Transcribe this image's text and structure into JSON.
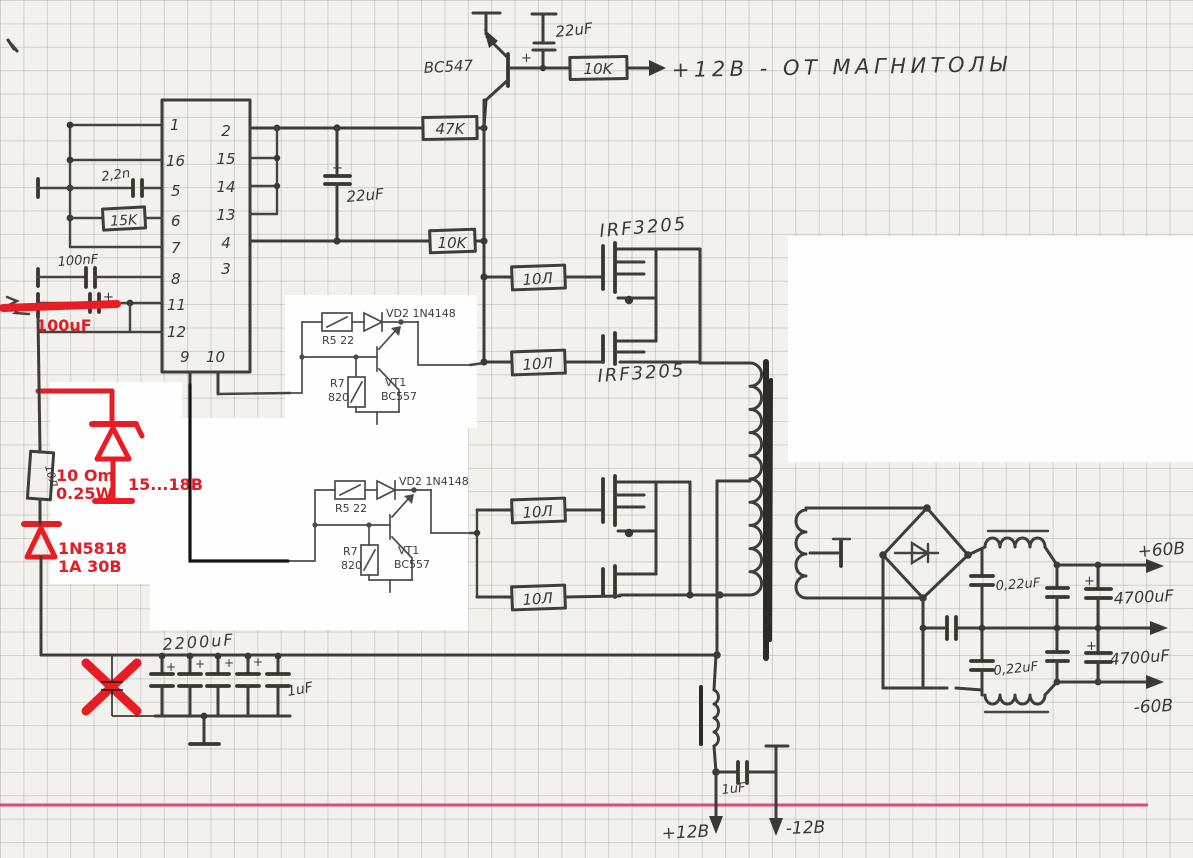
{
  "top": {
    "transistor": "BC547",
    "cap": "22uF",
    "resistor": "10K",
    "output_label": "+12В - ОТ МАГНИТОЛЫ"
  },
  "feedback": {
    "res_top": "47K",
    "cap": "22uF",
    "res_bottom": "10K"
  },
  "ic": {
    "left_pins": [
      "1",
      "16",
      "5",
      "6",
      "7",
      "8",
      "11",
      "12"
    ],
    "right_pins": [
      "2",
      "15",
      "14",
      "13",
      "4",
      "3"
    ],
    "bottom_pins": [
      "9",
      "10"
    ]
  },
  "left_inputs": {
    "timing_cap": "2,2n",
    "timing_res": "15K",
    "cap_100n": "100nF",
    "red_cap_note": "100uF"
  },
  "series": {
    "hand_res": "10Л"
  },
  "red_notes": {
    "series_res": "10 Om",
    "series_res_power": "0.25W",
    "zener": "15...18В",
    "schottky": "1N5818",
    "schottky_rating": "1A 30В"
  },
  "gate_resistors": [
    "10Л",
    "10Л",
    "10Л",
    "10Л"
  ],
  "mosfets": {
    "label_top": "IRF3205",
    "label_bottom": "IRF3205"
  },
  "drivers": [
    {
      "r5": "R5 22",
      "vd2": "VD2 1N4148",
      "r7": "R7",
      "r7_val": "820",
      "vt1": "VT1",
      "vt1_type": "BC557"
    },
    {
      "r5": "R5 22",
      "vd2": "VD2 1N4148",
      "r7": "R7",
      "r7_val": "820",
      "vt1": "VT1",
      "vt1_type": "BC557"
    }
  ],
  "bulk": {
    "bank_label": "2200uF",
    "small_cap": "1uF"
  },
  "output": {
    "film_cap_top": "0,22uF",
    "film_cap_bottom": "0,22uF",
    "elec_top": "4700uF",
    "elec_bottom": "4700uF",
    "rail_pos": "+60В",
    "rail_neg": "-60В"
  },
  "aux_rail": {
    "cap": "1uF",
    "pos": "+12В",
    "neg": "-12В"
  },
  "misc": {
    "plus": "+"
  }
}
